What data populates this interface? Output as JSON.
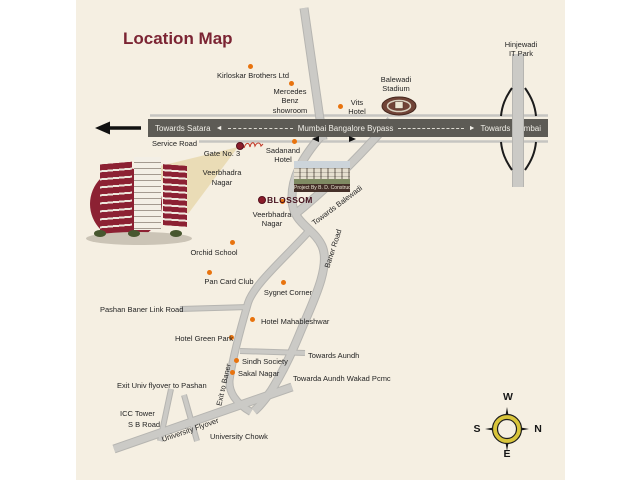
{
  "title": "Location Map",
  "colors": {
    "background": "#ffffff",
    "map_background": "#f5efe2",
    "title_maroon": "#7b2433",
    "road_gray": "#cbcac6",
    "highway_dark": "#5d5b55",
    "poi_dot_orange": "#e8730e",
    "poi_dot_maroon": "#8b1d2b",
    "compass_yellow": "#d9c53b"
  },
  "highway": {
    "towards_satara": "Towards Satara",
    "name": "Mumbai Bangalore Bypass",
    "towards_mumbai": "Towards Mumbai",
    "service_road": "Service Road"
  },
  "icons": {
    "arrow_left": "◄",
    "arrow_right": "►"
  },
  "landmarks": {
    "kirloskar": "Kirloskar Brothers Ltd",
    "mercedes": "Mercedes\nBenz\nshowroom",
    "vits": "Vits\nHotel",
    "balewadi_stadium": "Balewadi\nStadium",
    "hinjewadi": "Hinjewadi\nIT Park",
    "sadanand": "Sadanand\nHotel",
    "gate": "Gate No. 3",
    "gate_area": "Veerbhadra\nNagar",
    "veerbhadra": "Veerbhadra\nNagar",
    "blossom": "BLOSSOM",
    "orchid": "Orchid School",
    "pan_card": "Pan Card Club",
    "sygnet": "Sygnet Corner",
    "mahableshwar": "Hotel Mahableshwar",
    "green_park": "Hotel Green Park",
    "sindh": "Sindh Society",
    "sakal": "Sakal Nagar",
    "icc": "ICC Tower",
    "sb_road": "S B Road",
    "univ_chowk": "University Chowk"
  },
  "roads": {
    "baner": "Baner Road",
    "exit_baner": "Exit to Baner",
    "flyover": "University Flyover",
    "link_road": "Pashan Baner Link Road"
  },
  "directions": {
    "balewadi": "Towards Balewadi",
    "aundh": "Towards Aundh",
    "aundh_wakad": "Towarda Aundh Wakad Pcmc",
    "exit_pashan": "Exit Univ flyover to Pashan"
  },
  "project": {
    "caption": "Project By B. D. Constructions"
  },
  "compass": {
    "n": "N",
    "s": "S",
    "e": "E",
    "w": "W"
  }
}
